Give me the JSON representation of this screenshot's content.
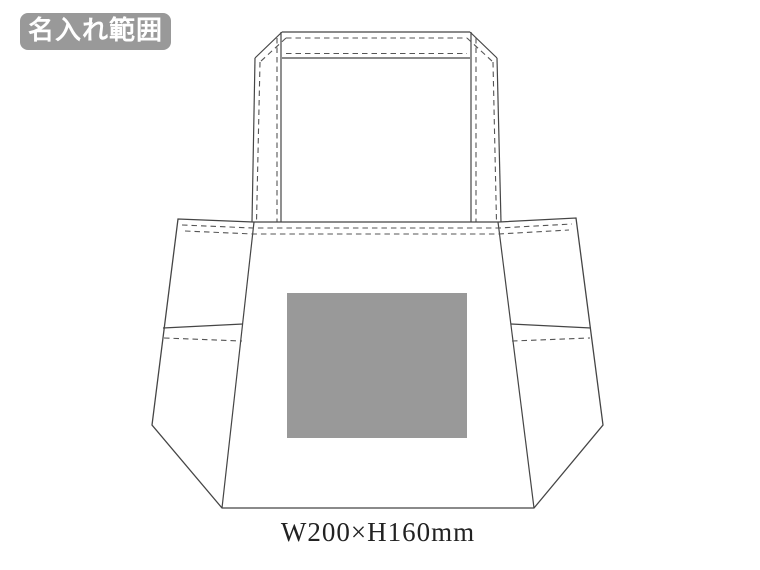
{
  "page": {
    "background_color": "#ffffff"
  },
  "badge": {
    "label": "名入れ範囲",
    "bg_color": "#999999",
    "text_color": "#ffffff"
  },
  "diagram": {
    "subject": "tote-bag-front-view",
    "line_color": "#454545",
    "stitch_line_color": "#555555",
    "print_area": {
      "fill_color": "#999999",
      "size_label": "W200×H160mm"
    }
  }
}
